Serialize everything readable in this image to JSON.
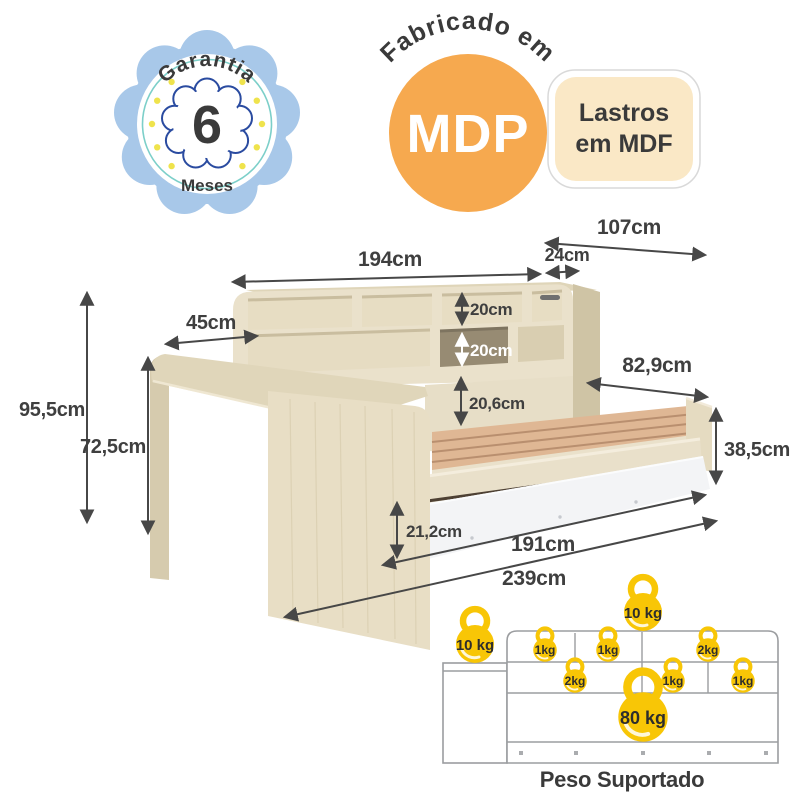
{
  "warranty_badge": {
    "title": "Garantia",
    "number": "6",
    "unit": "Meses"
  },
  "material_badge": {
    "arc_text": "Fabricado em",
    "label": "MDP"
  },
  "base_badge": {
    "line1": "Lastros",
    "line2": "em MDF"
  },
  "dimensions": {
    "side_width": "107cm",
    "shelf_length": "194cm",
    "shelf_depth": "24cm",
    "desk_depth": "45cm",
    "total_height": "95,5cm",
    "desk_height": "72,5cm",
    "niche_height_top": "20cm",
    "niche_height_bottom": "20cm",
    "backrest_height": "20,6cm",
    "bed_width": "82,9cm",
    "bed_side_height": "38,5cm",
    "drawer_front_height": "21,2cm",
    "bed_length": "191cm",
    "total_length": "239cm"
  },
  "weight_capacity": {
    "caption": "Peso Suportado",
    "desk_top": "10 kg",
    "shelf_top_overall": "10 kg",
    "bed": "80 kg",
    "compartments_row1": [
      "1kg",
      "1kg",
      "2kg"
    ],
    "compartments_row2": [
      "2kg",
      "1kg",
      "1kg"
    ]
  },
  "colors": {
    "accent_yellow": "#F8C606",
    "badge_blue": "#A8C8E9",
    "badge_navy": "#2A4BA0",
    "badge_teal": "#7CCFC9",
    "badge_orange": "#F6A94F",
    "badge_cream": "#FAE8C6",
    "wood_light": "#EAE1CB",
    "wood_dark": "#CFC4A5",
    "slats": "#DFB794",
    "drawer_white": "#F3F4F6",
    "label_text": "#3A3A3A",
    "diagram_outline": "#9B9DA0"
  }
}
